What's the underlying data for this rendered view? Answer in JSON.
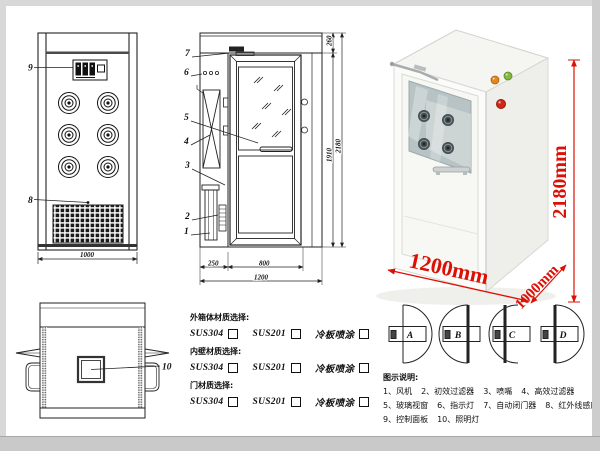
{
  "front_view": {
    "part_labels": {
      "control_panel": "9",
      "air_grille": "8"
    },
    "dims": {
      "width": "1000"
    }
  },
  "side_view": {
    "part_labels": [
      "7",
      "6",
      "5",
      "4",
      "3",
      "2",
      "1"
    ],
    "dims": {
      "top_section": "260",
      "door_height": "1910",
      "total_height": "2180",
      "left_width": "250",
      "door_width": "800",
      "total_width": "1200"
    }
  },
  "top_view": {
    "part_labels": [
      "10"
    ]
  },
  "photo": {
    "dim_height": "2180mm",
    "dim_width": "1200mm",
    "dim_depth": "1000mm",
    "dim_color": "#dd1005"
  },
  "materials": {
    "groups": [
      {
        "title": "外箱体材质选择:",
        "options": [
          "SUS304",
          "SUS201",
          "冷板喷涂"
        ]
      },
      {
        "title": "内壁材质选择:",
        "options": [
          "SUS304",
          "SUS201",
          "冷板喷涂"
        ]
      },
      {
        "title": "门材质选择:",
        "options": [
          "SUS304",
          "SUS201",
          "冷板喷涂"
        ]
      }
    ]
  },
  "door_options": {
    "labels": [
      "A",
      "B",
      "C",
      "D"
    ]
  },
  "legend": {
    "title": "图示说明:",
    "items": [
      "1、风机",
      "2、初效过滤器",
      "3、喷嘴",
      "4、高效过滤器",
      "5、玻璃视窗",
      "6、指示灯",
      "7、自动闭门器",
      "8、红外线感应器",
      "9、控制面板",
      "10、照明灯"
    ]
  }
}
